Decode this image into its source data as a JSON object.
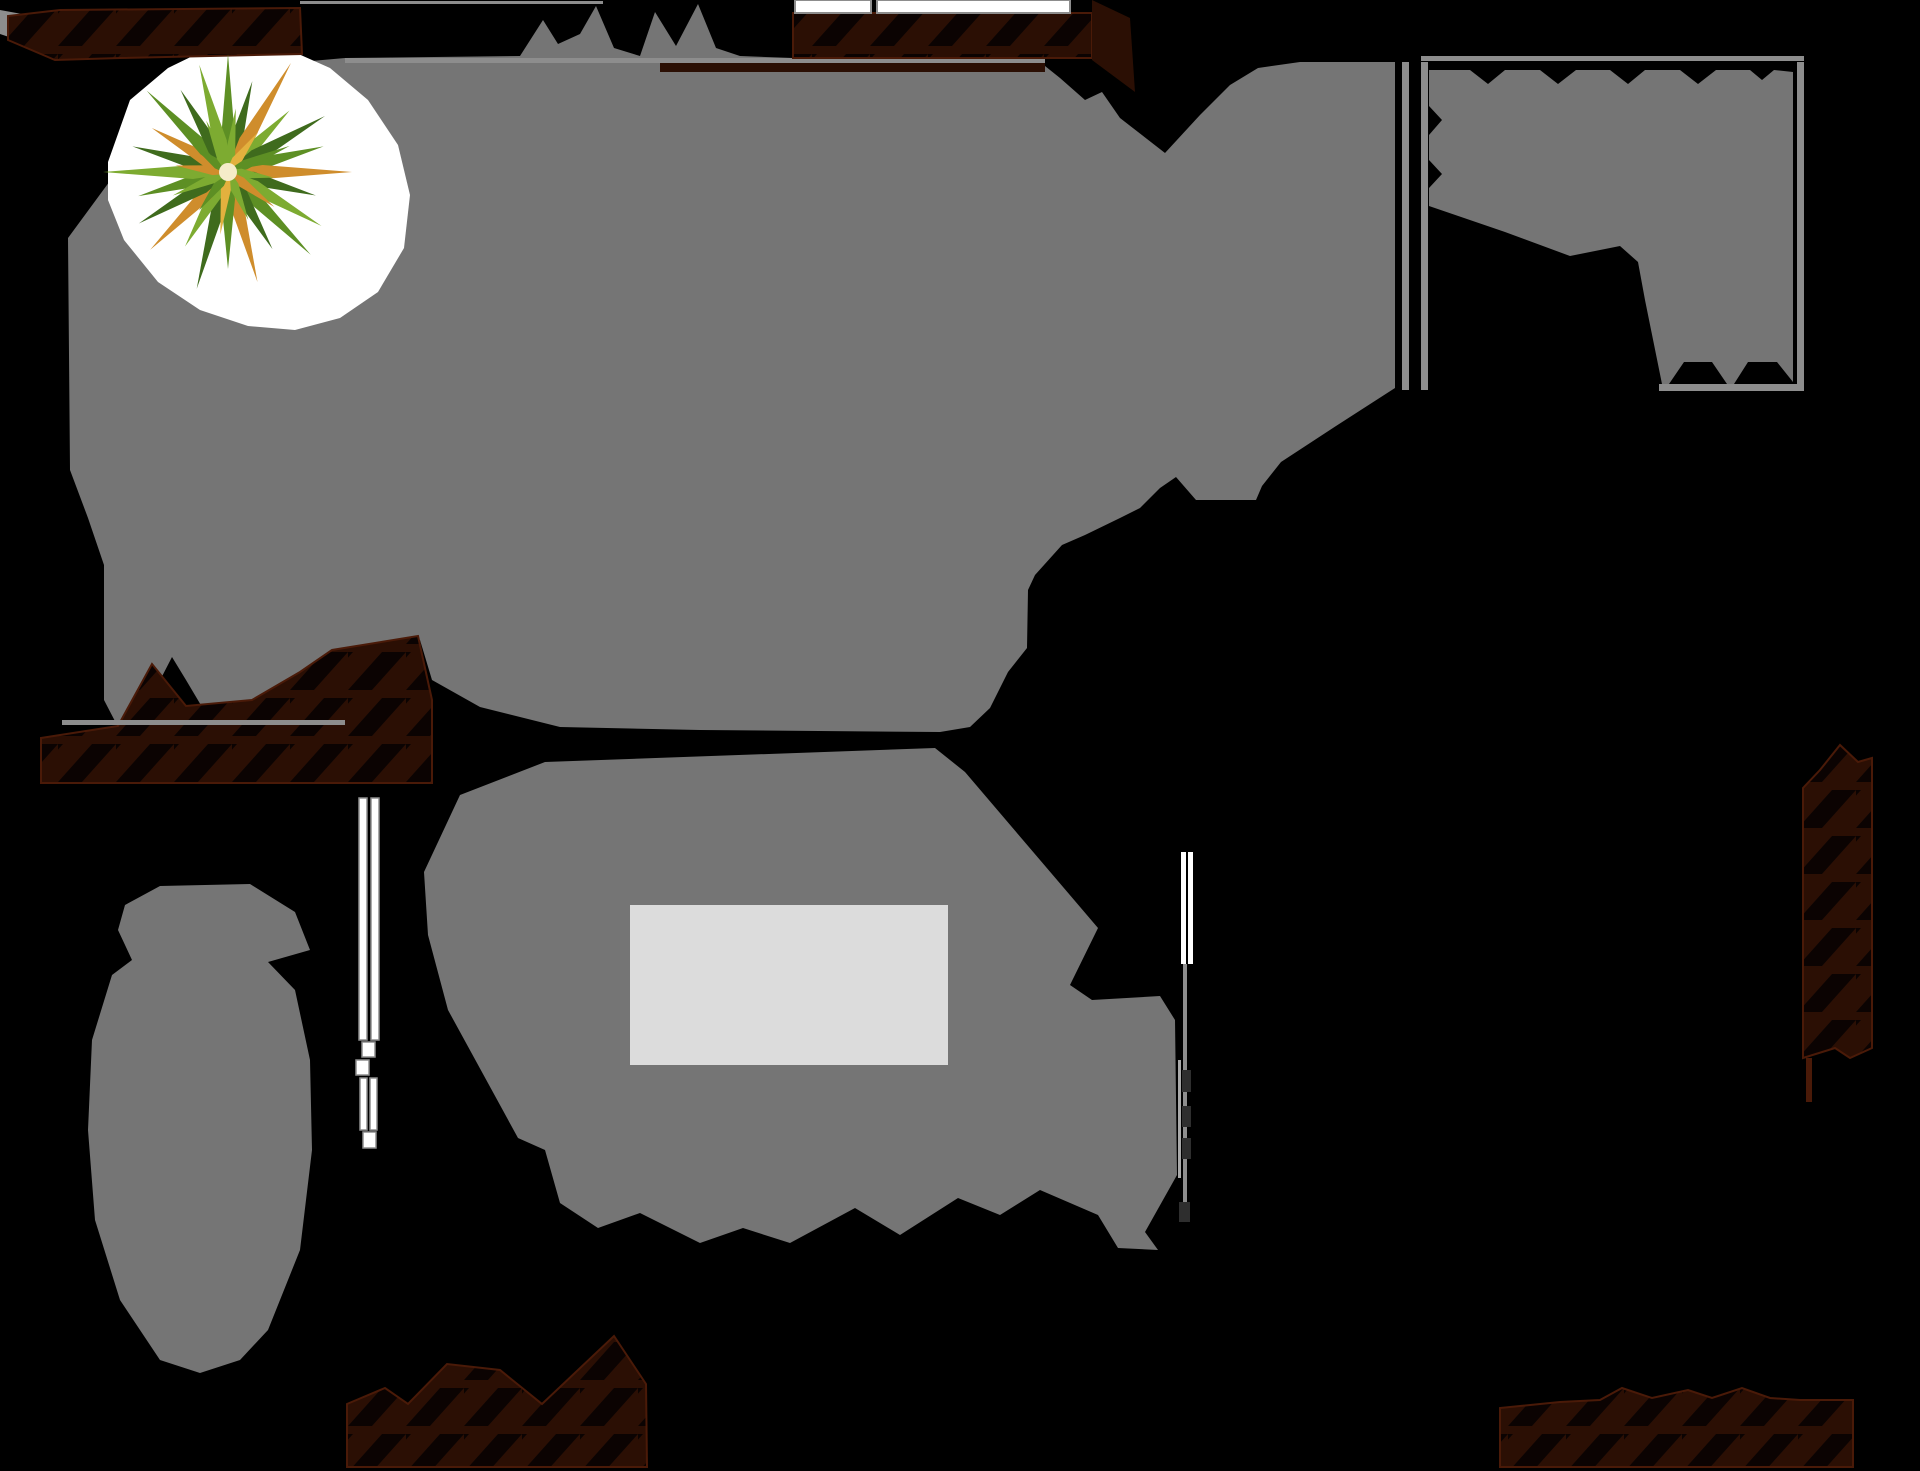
{
  "canvas": {
    "width": 1920,
    "height": 1471,
    "background": "#000000"
  },
  "palette": {
    "shadow": "#757575",
    "tableLight": "#dcdcdc",
    "white": "#ffffff",
    "wallFill": "#2b0f04",
    "wallEdge": "#4a1a08",
    "hatch": "#0b0302",
    "line": "#8d8d8d",
    "lineLight": "#a8a8a8",
    "lineDark": "#2e2e2e",
    "leafDark": "#3f6b1d",
    "leafMid": "#5d8f24",
    "leafLight": "#7dab31",
    "leafOrange": "#cf8d2c",
    "leafYellow": "#e3b13e",
    "plantCenter": "#f5ecc9",
    "backdrop": "#ffffff"
  },
  "shapes": [
    {
      "name": "shadow-main-room",
      "kind": "polygon",
      "fill": "shadow",
      "points": "68,238 140,140 210,85 300,62 345,58 520,56 543,20 558,44 580,34 596,6 614,48 640,56 655,12 676,46 698,4 716,48 740,56 793,58 1045,58 1045,66 1060,78 1085,100 1102,92 1120,118 1165,153 1200,115 1230,85 1258,68 1300,62 1395,62 1395,388 1336,426 1281,462 1262,486 1256,500 1196,500 1176,477 1160,488 1140,508 1120,518 1085,535 1062,545 1035,575 1028,590 1027,648 1008,672 990,708 970,727 940,732 700,730 560,727 480,707 432,680 420,640 390,642 330,652 290,680 252,702 205,712 186,680 172,657 155,690 140,727 118,727 104,700 104,565 88,518 70,470"
    },
    {
      "name": "top-edge-wall-line",
      "kind": "rect",
      "fill": "line",
      "rect": [
        345,
        58,
        700,
        5
      ]
    },
    {
      "name": "plant-backdrop",
      "kind": "polygon",
      "fill": "backdrop",
      "points": "108,162 130,100 168,68 205,50 240,40 285,48 330,68 368,100 398,145 410,195 404,248 378,292 340,318 295,330 248,326 200,310 158,282 124,240 108,200"
    },
    {
      "name": "corner-tick",
      "kind": "polygon",
      "fill": "line",
      "points": "0,10 22,14 12,38 0,34"
    },
    {
      "name": "wall-brick-top-left",
      "kind": "polygon",
      "fill": "brick",
      "stroke": "wallEdge",
      "sw": 2,
      "points": "8,40 8,16 60,10 300,8 302,54 120,58 55,60"
    },
    {
      "name": "wall-brick-top-center",
      "kind": "rect",
      "fill": "brick",
      "stroke": "wallEdge",
      "sw": 2,
      "rect": [
        793,
        13,
        299,
        45
      ]
    },
    {
      "name": "wall-under-strip",
      "kind": "rect",
      "fill": "wallFill",
      "rect": [
        660,
        63,
        385,
        9
      ]
    },
    {
      "name": "wall-wedge-top-right",
      "kind": "polygon",
      "fill": "wallFill",
      "points": "1092,0 1130,18 1135,92 1092,60"
    },
    {
      "name": "wall-brick-left-middle",
      "kind": "polygon",
      "fill": "brick",
      "stroke": "wallEdge",
      "sw": 2,
      "points": "41,783 41,738 118,726 152,664 186,706 252,700 300,672 332,650 418,636 432,700 432,783"
    },
    {
      "name": "wall-brick-right-column",
      "kind": "polygon",
      "fill": "brick",
      "stroke": "wallEdge",
      "sw": 2,
      "points": "1803,1058 1803,788 1820,770 1840,745 1858,762 1872,758 1872,1048 1850,1058 1835,1048"
    },
    {
      "name": "wall-brick-bottom-left",
      "kind": "polygon",
      "fill": "brick",
      "stroke": "wallEdge",
      "sw": 2,
      "points": "347,1467 347,1404 385,1388 408,1404 447,1364 500,1370 542,1404 614,1336 646,1384 647,1467"
    },
    {
      "name": "wall-brick-bottom-right",
      "kind": "polygon",
      "fill": "brick",
      "stroke": "wallEdge",
      "sw": 2,
      "points": "1500,1467 1500,1408 1560,1402 1600,1400 1622,1388 1652,1398 1688,1390 1712,1398 1742,1388 1770,1398 1800,1400 1853,1400 1853,1467"
    },
    {
      "name": "shadow-top-right-room",
      "kind": "polygon",
      "fill": "shadow",
      "points": "1429,70 1470,70 1488,84 1505,70 1540,70 1558,84 1576,70 1610,70 1628,84 1645,70 1680,70 1698,84 1716,70 1750,70 1762,80 1774,70 1793,72 1793,382 1777,362 1748,362 1734,384 1727,384 1712,362 1684,362 1669,384 1662,384 1645,300 1638,262 1620,246 1570,256 1505,232 1429,206 1429,188 1442,174 1429,160 1429,135 1442,120 1429,106"
    },
    {
      "name": "room-divider-wall-line",
      "kind": "rect",
      "fill": "line",
      "rect": [
        1402,
        62,
        7,
        328
      ]
    },
    {
      "name": "room-left-wall-line",
      "kind": "rect",
      "fill": "line",
      "rect": [
        1421,
        62,
        7,
        328
      ]
    },
    {
      "name": "room-right-wall-line",
      "kind": "rect",
      "fill": "line",
      "rect": [
        1797,
        62,
        7,
        328
      ]
    },
    {
      "name": "room-top-wall-line",
      "kind": "rect",
      "fill": "line",
      "rect": [
        1421,
        56,
        383,
        5
      ]
    },
    {
      "name": "room-bottom-wall-line",
      "kind": "rect",
      "fill": "line",
      "rect": [
        1659,
        384,
        145,
        7
      ]
    },
    {
      "name": "shadow-dining-area",
      "kind": "polygon",
      "fill": "shadow",
      "points": "545,762 935,748 965,772 1098,928 1070,985 1092,1000 1160,996 1175,1020 1177,1175 1145,1232 1158,1250 1118,1248 1098,1215 1040,1190 1000,1215 958,1198 900,1235 855,1208 790,1243 743,1228 700,1243 640,1213 598,1228 560,1203 545,1150 518,1138 448,1010 428,935 424,872 460,795"
    },
    {
      "name": "table-highlight",
      "kind": "rect",
      "fill": "tableLight",
      "rect": [
        630,
        905,
        318,
        160
      ]
    },
    {
      "name": "shadow-armchairs",
      "kind": "polygon",
      "fill": "shadow",
      "points": "160,886 250,884 295,912 310,950 268,962 295,990 310,1060 312,1150 300,1250 268,1330 240,1360 200,1373 160,1360 120,1300 95,1220 88,1130 92,1040 112,975 132,960 118,930 125,905"
    },
    {
      "name": "left-wall-inner-line",
      "kind": "rect",
      "fill": "line",
      "rect": [
        62,
        720,
        283,
        5
      ]
    },
    {
      "name": "top-sill-line",
      "kind": "rect",
      "fill": "line",
      "rect": [
        300,
        1,
        303,
        3
      ]
    },
    {
      "name": "window-top-pane-left",
      "kind": "rect",
      "fill": "white",
      "stroke": "line",
      "sw": 2,
      "rect": [
        795,
        0,
        76,
        13
      ]
    },
    {
      "name": "window-top-pane-right",
      "kind": "rect",
      "fill": "white",
      "stroke": "line",
      "sw": 2,
      "rect": [
        877,
        0,
        193,
        13
      ]
    },
    {
      "name": "window-left-bar-a",
      "kind": "rect",
      "fill": "white",
      "stroke": "line",
      "sw": 1.5,
      "rect": [
        359,
        798,
        8,
        242
      ]
    },
    {
      "name": "window-left-bar-b",
      "kind": "rect",
      "fill": "white",
      "stroke": "line",
      "sw": 1.5,
      "rect": [
        371,
        798,
        8,
        242
      ]
    },
    {
      "name": "window-left-cap-a",
      "kind": "rect",
      "fill": "white",
      "stroke": "line",
      "sw": 1.5,
      "rect": [
        362,
        1042,
        13,
        15
      ]
    },
    {
      "name": "window-left-cap-b",
      "kind": "rect",
      "fill": "white",
      "stroke": "line",
      "sw": 1.5,
      "rect": [
        356,
        1060,
        13,
        15
      ]
    },
    {
      "name": "window-left-bar-c",
      "kind": "rect",
      "fill": "white",
      "stroke": "line",
      "sw": 1.5,
      "rect": [
        360,
        1078,
        7,
        52
      ]
    },
    {
      "name": "window-left-bar-d",
      "kind": "rect",
      "fill": "white",
      "stroke": "line",
      "sw": 1.5,
      "rect": [
        370,
        1078,
        7,
        52
      ]
    },
    {
      "name": "window-left-cap-c",
      "kind": "rect",
      "fill": "white",
      "stroke": "line",
      "sw": 1.5,
      "rect": [
        363,
        1132,
        13,
        16
      ]
    },
    {
      "name": "window-right-bar-a",
      "kind": "rect",
      "fill": "white",
      "rect": [
        1181,
        852,
        5,
        112
      ]
    },
    {
      "name": "window-right-bar-b",
      "kind": "rect",
      "fill": "white",
      "rect": [
        1188,
        852,
        5,
        112
      ]
    },
    {
      "name": "wall-right-thin-line",
      "kind": "rect",
      "fill": "lineLight",
      "rect": [
        1178,
        1060,
        3,
        118
      ]
    },
    {
      "name": "wall-right-line",
      "kind": "rect",
      "fill": "line",
      "rect": [
        1183,
        964,
        4,
        246
      ]
    },
    {
      "name": "wall-right-mark-a",
      "kind": "rect",
      "fill": "lineDark",
      "rect": [
        1182,
        1070,
        9,
        22
      ]
    },
    {
      "name": "wall-right-mark-b",
      "kind": "rect",
      "fill": "lineDark",
      "rect": [
        1182,
        1106,
        9,
        21
      ]
    },
    {
      "name": "wall-right-mark-c",
      "kind": "rect",
      "fill": "lineDark",
      "rect": [
        1182,
        1138,
        9,
        21
      ]
    },
    {
      "name": "wall-right-endcap",
      "kind": "rect",
      "fill": "lineDark",
      "rect": [
        1179,
        1202,
        11,
        20
      ]
    },
    {
      "name": "wall-right-column-tail",
      "kind": "rect",
      "fill": "wallEdge",
      "rect": [
        1806,
        1058,
        6,
        44
      ]
    }
  ],
  "plant": {
    "cx": 228,
    "cy": 172,
    "outer": {
      "width": 7,
      "angles": [
        0,
        15,
        30,
        45,
        60,
        75,
        90,
        105,
        120,
        135,
        150,
        165,
        180,
        195,
        210,
        225,
        240,
        255,
        270,
        285,
        300,
        315,
        330,
        345
      ],
      "lengths": [
        118,
        94,
        126,
        87,
        112,
        99,
        124,
        91,
        108,
        117,
        89,
        114,
        97,
        121,
        86,
        110,
        103,
        93,
        125,
        99,
        88,
        115,
        95,
        111
      ],
      "colors": [
        "leafMid",
        "leafDark",
        "leafOrange",
        "leafLight",
        "leafDark",
        "leafMid",
        "leafOrange",
        "leafDark",
        "leafLight",
        "leafMid",
        "leafDark",
        "leafOrange",
        "leafMid",
        "leafDark",
        "leafLight",
        "leafOrange",
        "leafDark",
        "leafMid",
        "leafLight",
        "leafDark",
        "leafOrange",
        "leafMid",
        "leafDark",
        "leafLight"
      ]
    },
    "inner": {
      "width": 5,
      "angles": [
        7,
        37,
        67,
        97,
        127,
        157,
        187,
        217,
        247,
        277,
        307,
        337
      ],
      "lengths": [
        64,
        50,
        67,
        46,
        58,
        52,
        63,
        48,
        60,
        53,
        45,
        56
      ],
      "colors": [
        "leafLight",
        "leafYellow",
        "leafMid",
        "leafLight",
        "leafOrange",
        "leafLight",
        "leafYellow",
        "leafMid",
        "leafLight",
        "leafOrange",
        "leafMid",
        "leafLight"
      ]
    },
    "center_radius": 9
  }
}
